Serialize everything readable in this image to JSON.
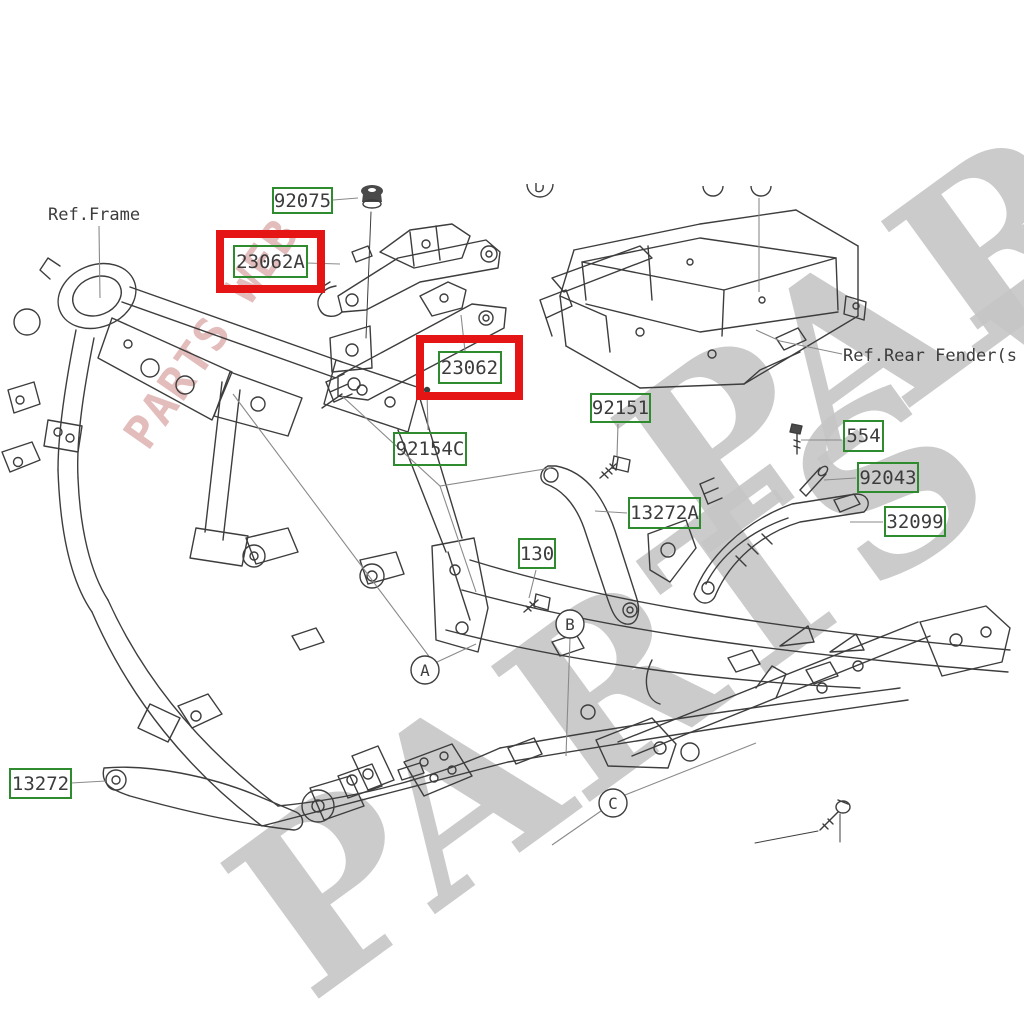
{
  "diagram": {
    "ref_labels": [
      {
        "id": "ref-frame",
        "text": "Ref.Frame"
      },
      {
        "id": "ref-rear-fender",
        "text": "Ref.Rear Fender(s"
      }
    ],
    "part_labels": [
      {
        "part_number": "92075",
        "highlighted": false
      },
      {
        "part_number": "23062A",
        "highlighted": true
      },
      {
        "part_number": "23062",
        "highlighted": true
      },
      {
        "part_number": "92154C",
        "highlighted": false
      },
      {
        "part_number": "92151",
        "highlighted": false
      },
      {
        "part_number": "13272A",
        "highlighted": false
      },
      {
        "part_number": "130",
        "highlighted": false
      },
      {
        "part_number": "554",
        "highlighted": false
      },
      {
        "part_number": "92043",
        "highlighted": false
      },
      {
        "part_number": "32099",
        "highlighted": false
      },
      {
        "part_number": "13272",
        "highlighted": false
      }
    ],
    "callouts": [
      {
        "letter": "A"
      },
      {
        "letter": "B"
      },
      {
        "letter": "C"
      }
    ],
    "watermark": {
      "text": "PARTS WEB"
    },
    "colors": {
      "label_border": "#2e8b2e",
      "highlight_box": "#e51515",
      "line_art": "#3d3d3d",
      "watermark_gray": "#c4c4c4",
      "watermark_red": "#d8a0a0"
    }
  }
}
